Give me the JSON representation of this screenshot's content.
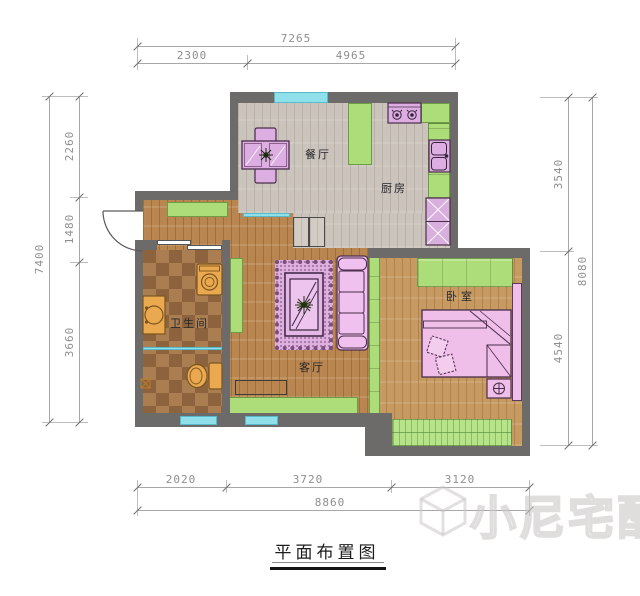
{
  "title": {
    "text": "平面布置图"
  },
  "rooms": {
    "dining": "餐厅",
    "kitchen": "厨房",
    "bathroom": "卫生间",
    "living": "客厅",
    "bedroom": "卧室"
  },
  "dimensions": {
    "top": {
      "total": "7265",
      "seg1": "2300",
      "seg2": "4965"
    },
    "left": {
      "total": "7400",
      "seg1": "2260",
      "seg2": "1480",
      "seg3": "3660"
    },
    "right": {
      "total": "8080",
      "seg1": "3540",
      "seg2": "4540"
    },
    "bottom": {
      "total": "8860",
      "seg1": "2020",
      "seg2": "3720",
      "seg3": "3120"
    }
  },
  "watermark": {
    "text": "小尼宅配",
    "icon": "cube-logo-icon"
  },
  "colors": {
    "wall": "#6D6A6A",
    "cabinet_green": "#ACDD78",
    "glass_cyan": "#8FE0EA",
    "furniture_purple": "#DCAEE2",
    "furniture_pink": "#EFBFEA",
    "fixture_orange": "#EAA94E",
    "floor_gray_wood": "#CBC4BC",
    "floor_brown_wood": "#B9864F",
    "floor_bedroom_wood": "#C69A60",
    "dimension_gray": "#8E8E8E"
  }
}
